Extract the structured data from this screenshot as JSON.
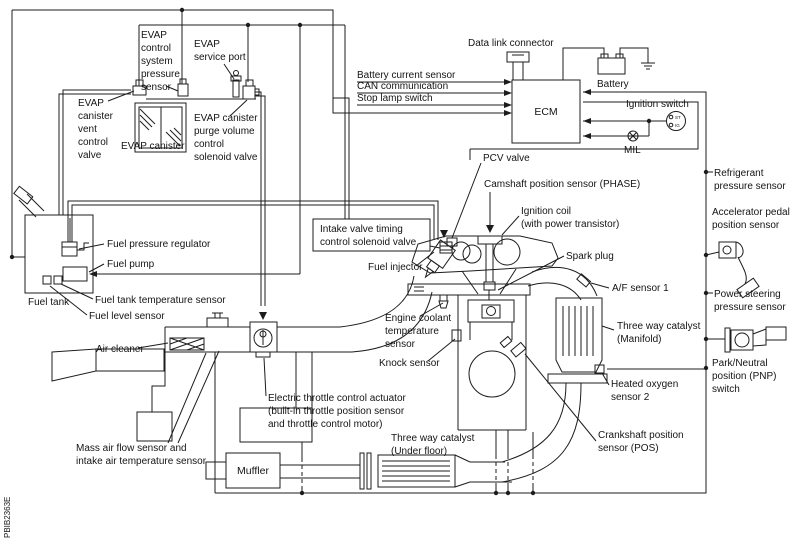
{
  "diagram": {
    "type": "engine-control-system-component-diagram",
    "figure_code": "PBIB2363E",
    "colors": {
      "line": "#1c1c1c",
      "text": "#141414",
      "background": "#ffffff"
    }
  },
  "labels": {
    "evap_control_system_pressure_sensor": [
      "EVAP",
      "control",
      "system",
      "pressure",
      "sensor"
    ],
    "evap_service_port": [
      "EVAP",
      "service port"
    ],
    "evap_canister_vent_control_valve": [
      "EVAP",
      "canister",
      "vent",
      "control",
      "valve"
    ],
    "evap_canister": "EVAP canister",
    "evap_canister_purge": [
      "EVAP canister",
      "purge volume",
      "control",
      "solenoid valve"
    ],
    "battery_current_sensor": "Battery current sensor",
    "can_communication": "CAN communication",
    "stop_lamp_switch": "Stop lamp switch",
    "data_link_connector": "Data link connector",
    "ecm": "ECM",
    "battery": "Battery",
    "ignition_switch": "Ignition switch",
    "ignition_switch_positions": [
      "ST",
      "IG"
    ],
    "mil": "MIL",
    "pcv_valve": "PCV valve",
    "camshaft_position_sensor": "Camshaft position sensor (PHASE)",
    "ignition_coil": [
      "Ignition coil",
      "(with power transistor)"
    ],
    "spark_plug": "Spark plug",
    "af_sensor_1": "A/F sensor 1",
    "three_way_catalyst_manifold": [
      "Three way catalyst",
      "(Manifold)"
    ],
    "heated_oxygen_sensor_2": [
      "Heated oxygen",
      "sensor 2"
    ],
    "crankshaft_position_sensor": [
      "Crankshaft position",
      "sensor (POS)"
    ],
    "engine_coolant_temperature_sensor": [
      "Engine coolant",
      "temperature",
      "sensor"
    ],
    "knock_sensor": "Knock sensor",
    "three_way_catalyst_under_floor": [
      "Three way catalyst",
      "(Under floor)"
    ],
    "intake_valve_timing": [
      "Intake valve timing",
      "control solenoid valve"
    ],
    "fuel_injector": "Fuel injector",
    "fuel_pressure_regulator": "Fuel pressure regulator",
    "fuel_pump": "Fuel pump",
    "fuel_tank": "Fuel tank",
    "fuel_tank_temperature_sensor": "Fuel tank temperature sensor",
    "fuel_level_sensor": "Fuel level sensor",
    "air_cleaner": "Air cleaner",
    "mass_air_flow": [
      "Mass air flow sensor and",
      "intake air temperature sensor"
    ],
    "electric_throttle": [
      "Electric throttle control actuator",
      "(built-in throttle position sensor",
      "and throttle control motor)"
    ],
    "muffler": "Muffler",
    "refrigerant_pressure_sensor": [
      "Refrigerant",
      "pressure sensor"
    ],
    "accelerator_pedal": [
      "Accelerator pedal",
      "position sensor"
    ],
    "power_steering_pressure_sensor": [
      "Power steering",
      "pressure sensor"
    ],
    "pnp_switch": [
      "Park/Neutral",
      "position (PNP)",
      "switch"
    ]
  }
}
